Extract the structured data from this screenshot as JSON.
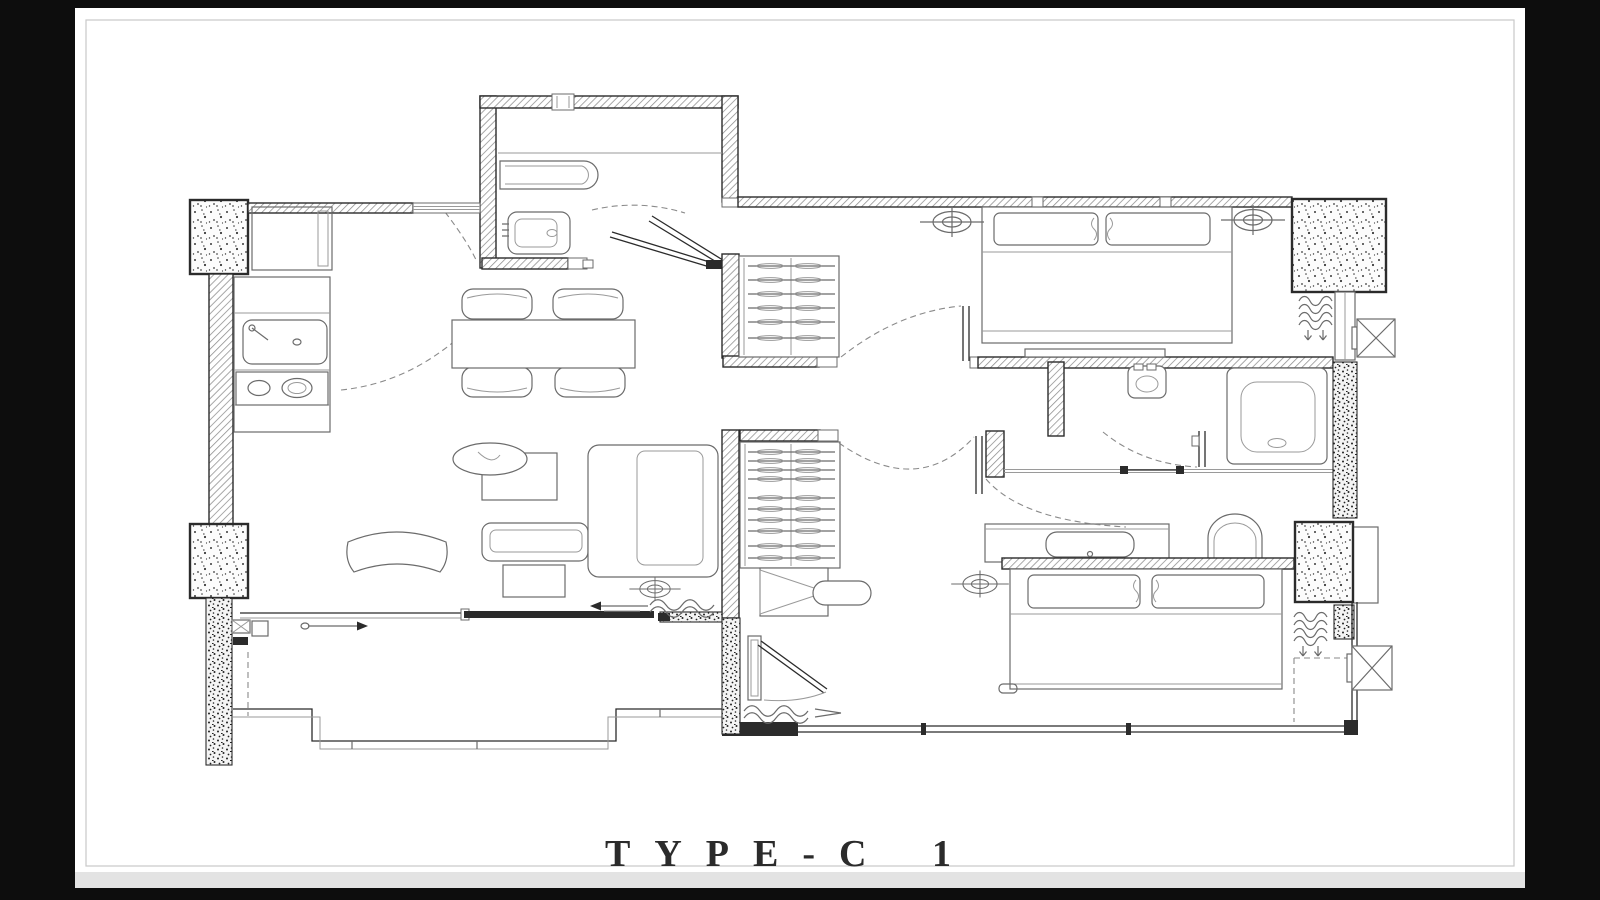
{
  "title": "TYPE-C 1",
  "colors": {
    "frame": "#0d0d0d",
    "page": "#ffffff",
    "page_edge": "#e3e3e3",
    "page_border": "#c8c8c8",
    "line": "#2b2b2b",
    "fixture": "#6b6b6b",
    "light": "#9a9a9a",
    "hatch": "#8c8c8c"
  },
  "plan": {
    "type": "apartment-floor-plan",
    "rooms": [
      "kitchen",
      "dining-area",
      "living-room",
      "entry-hall",
      "bathroom-1",
      "bathroom-2",
      "bedroom-1",
      "bedroom-2",
      "dressing-area",
      "walk-in-closet-1",
      "walk-in-closet-2",
      "balcony"
    ],
    "fixtures": [
      "bathtub",
      "toilet",
      "wash-basin",
      "kitchen-sink",
      "cooktop",
      "refrigerator",
      "dining-table",
      "dining-chairs",
      "l-shaped-sofa",
      "coffee-table",
      "side-table",
      "potted-plant",
      "armchair",
      "double-bed",
      "pillows",
      "wardrobe-hanger-rails",
      "dresser-stool",
      "vanity-counter",
      "ceiling-lights",
      "ac-outdoor-units",
      "condenser-coils",
      "sliding-door",
      "swing-doors",
      "balcony-railing",
      "concrete-columns"
    ]
  }
}
